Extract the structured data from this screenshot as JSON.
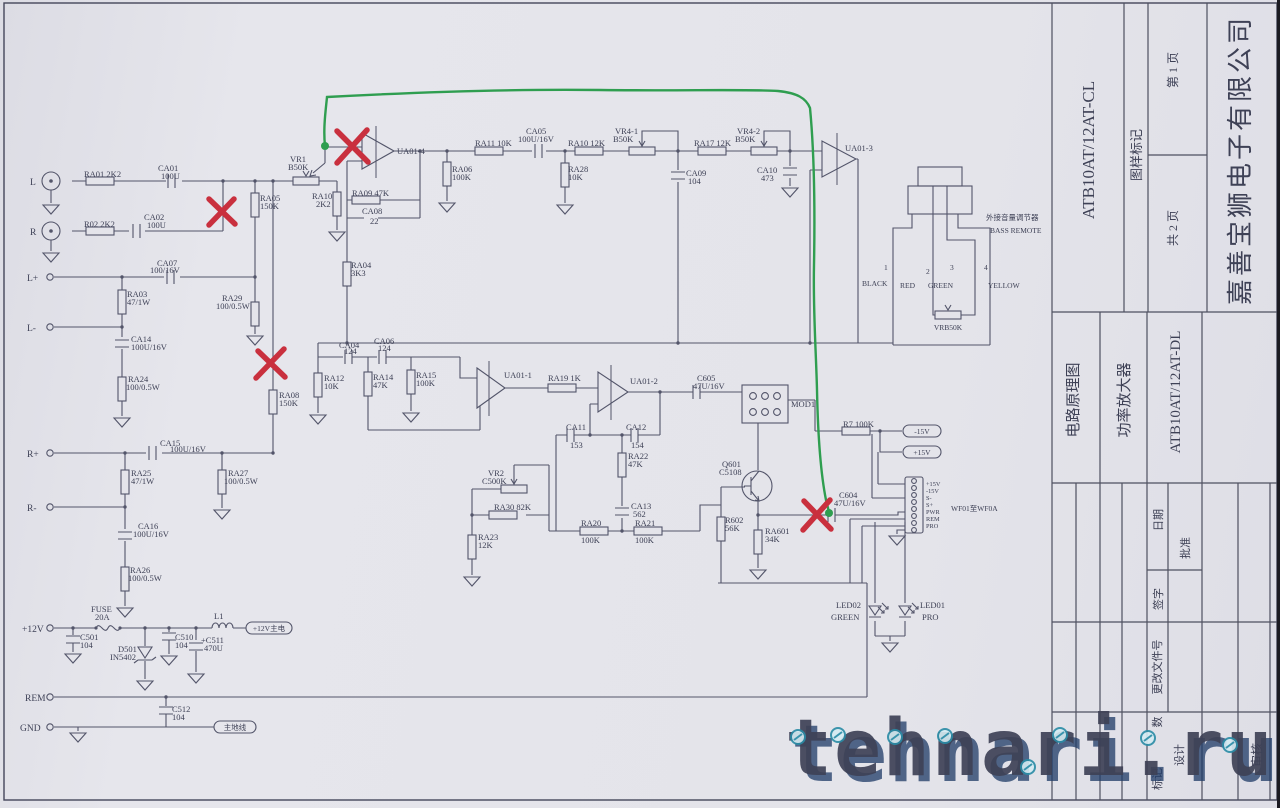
{
  "colors": {
    "paper": "#e4e4ea",
    "line": "#53556a",
    "ink": "#3e4156",
    "red_x": "#c9303e",
    "green_trace": "#2f9e50",
    "watermark_blue": "#2f77b5",
    "watermark_light": "#d8e9f6",
    "watermark_shadow": "#1e3a66"
  },
  "title_block": {
    "doc_code_top": "ATB10AT/12AT-CL",
    "stamp_label": "图样标记",
    "page_no": "第 1 页",
    "pages_total": "共 2 页",
    "company": "嘉善宝狮电子有限公司",
    "doc_type": "电路原理图",
    "product": "功率放大器",
    "doc_code_bottom": "ATB10AT/12AT-DL",
    "date_label": "日期",
    "approve_label": "批准",
    "sign_label": "签字",
    "change_file_label": "更改文件号",
    "count_label": "数",
    "mark_label": "标记",
    "design_label": "设计",
    "review_label": "审核"
  },
  "watermark": {
    "text": "tehnari.ru"
  },
  "terminals": {
    "l": "L",
    "r": "R",
    "lp": "L+",
    "lm": "L-",
    "rp": "R+",
    "rm": "R-",
    "v12": "+12V",
    "rem": "REM",
    "gnd": "GND"
  },
  "net_tags": {
    "v12_out": "+12V主电",
    "gnd_out": "主地线",
    "m15": "-15V",
    "p15": "+15V"
  },
  "remote": {
    "cn": "外接音量调节器",
    "en": "BASS REMOTE",
    "pins": [
      "1",
      "2",
      "3",
      "4"
    ],
    "wire_colors": [
      "BLACK",
      "RED",
      "GREEN",
      "YELLOW"
    ],
    "pot": [
      "VRB50K"
    ]
  },
  "wf": {
    "note": "WF01至WF0A",
    "pins": [
      "+15V",
      "-15V",
      "S-",
      "S+",
      "PWR",
      "REM",
      "PRO"
    ]
  },
  "components": {
    "ra01": [
      "RA01 2K2"
    ],
    "ca01": [
      "CA01",
      "100U"
    ],
    "r02": [
      "R02 2K2"
    ],
    "ca02": [
      "CA02",
      "100U"
    ],
    "ra05": [
      "RA05",
      "150K"
    ],
    "vr1": [
      "VR1",
      "B50K"
    ],
    "ca07": [
      "CA07",
      "100/16V"
    ],
    "ra03": [
      "RA03",
      "47/1W"
    ],
    "ra29": [
      "RA29",
      "100/0.5W"
    ],
    "ca14": [
      "CA14",
      "100U/16V"
    ],
    "ra24": [
      "RA24",
      "100/0.5W"
    ],
    "ra08": [
      "RA08",
      "150K"
    ],
    "ca15": [
      "CA15",
      "100U/16V"
    ],
    "ra25": [
      "RA25",
      "47/1W"
    ],
    "ra27": [
      "RA27",
      "100/0.5W"
    ],
    "ca16": [
      "CA16",
      "100U/16V"
    ],
    "ra26": [
      "RA26",
      "100/0.5W"
    ],
    "ra10a": [
      "RA10",
      "2K2"
    ],
    "ra09": [
      "RA09  47K"
    ],
    "ca08": [
      "CA08",
      "22"
    ],
    "ra04": [
      "RA04",
      "3K3"
    ],
    "ua01_4": [
      "UA01-4"
    ],
    "ra06": [
      "RA06",
      "100K"
    ],
    "ra11": [
      "RA11 10K"
    ],
    "ca05": [
      "CA05",
      "100U/16V"
    ],
    "ra28": [
      "RA28",
      "10K"
    ],
    "ra10b": [
      "RA10  12K"
    ],
    "vr4_1": [
      "VR4-1",
      "B50K"
    ],
    "ca09": [
      "CA09",
      "104"
    ],
    "ra17": [
      "RA17  12K"
    ],
    "vr4_2": [
      "VR4-2",
      "B50K"
    ],
    "ca10": [
      "CA10",
      "473"
    ],
    "ua01_3": [
      "UA01-3"
    ],
    "ca04": [
      "CA04",
      "124"
    ],
    "ca06": [
      "CA06",
      "124"
    ],
    "ra12": [
      "RA12",
      "10K"
    ],
    "ra14": [
      "RA14",
      "47K"
    ],
    "ra15": [
      "RA15",
      "100K"
    ],
    "ua01_1": [
      "UA01-1"
    ],
    "ra19": [
      "RA19 1K"
    ],
    "ua01_2": [
      "UA01-2"
    ],
    "ca11": [
      "CA11",
      "153"
    ],
    "ca12": [
      "CA12",
      "154"
    ],
    "ra22": [
      "RA22",
      "47K"
    ],
    "ca13": [
      "CA13",
      "562"
    ],
    "ra20": [
      "RA20",
      "100K"
    ],
    "ra21": [
      "RA21",
      "100K"
    ],
    "vr2": [
      "VR2",
      "C500K"
    ],
    "ra30": [
      "RA30 82K"
    ],
    "ra23": [
      "RA23",
      "12K"
    ],
    "c605": [
      "C605",
      "47U/16V"
    ],
    "mod1": [
      "MOD1"
    ],
    "q601": [
      "Q601",
      "C5108"
    ],
    "r602": [
      "R602",
      "56K"
    ],
    "ra601": [
      "RA601",
      "34K"
    ],
    "r7": [
      "R7  100K"
    ],
    "c604": [
      "C604",
      "47U/16V"
    ],
    "fuse": [
      "FUSE",
      "20A"
    ],
    "c501": [
      "C501",
      "104"
    ],
    "d501": [
      "D501",
      "IN5402"
    ],
    "c510": [
      "C510",
      "104"
    ],
    "c511": [
      "+C511",
      "470U"
    ],
    "l1": [
      "L1"
    ],
    "c512": [
      "C512",
      "104"
    ],
    "led02": [
      "LED02",
      "GREEN"
    ],
    "led01": [
      "LED01",
      "PRO"
    ]
  }
}
